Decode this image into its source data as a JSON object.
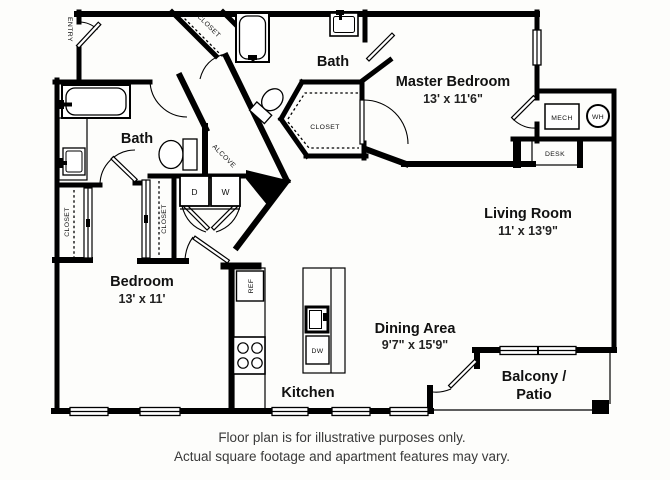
{
  "rooms": {
    "master_bedroom": {
      "name": "Master Bedroom",
      "dims": "13' x 11'6\""
    },
    "living_room": {
      "name": "Living Room",
      "dims": "11' x 13'9\""
    },
    "bedroom": {
      "name": "Bedroom",
      "dims": "13' x 11'"
    },
    "dining_area": {
      "name": "Dining Area",
      "dims": "9'7\" x 15'9\""
    },
    "kitchen": {
      "name": "Kitchen"
    },
    "bath_upper": {
      "name": "Bath"
    },
    "bath_lower": {
      "name": "Bath"
    },
    "balcony": {
      "name_line1": "Balcony /",
      "name_line2": "Patio"
    },
    "entry": {
      "name": "ENTRY"
    },
    "alcove": {
      "name": "ALCOVE"
    }
  },
  "closets": {
    "entry_closet": "CLOSET",
    "master_closet": "CLOSET",
    "bedroom_closet_left": "CLOSET",
    "bedroom_closet_right": "CLOSET"
  },
  "appliances": {
    "dryer": "D",
    "washer": "W",
    "mech": "MECH",
    "water_heater": "WH",
    "desk": "DESK",
    "refrigerator": "REF",
    "dishwasher": "DW"
  },
  "disclaimer": {
    "line1": "Floor plan is for illustrative purposes only.",
    "line2": "Actual square footage and apartment features may vary."
  },
  "colors": {
    "wall": "#000000",
    "background": "#fdfdfb"
  }
}
